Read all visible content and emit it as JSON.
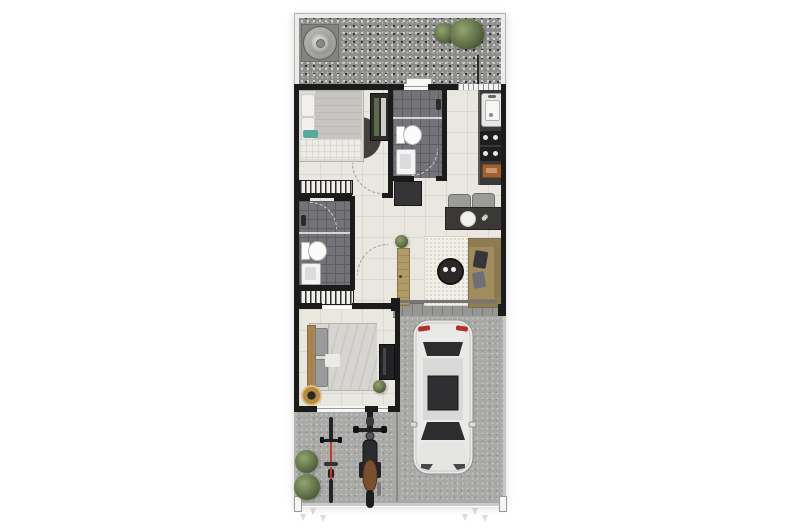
{
  "scene": {
    "type": "floor-plan",
    "style": "3d-rendered top-down plan of a narrow single-storey house with rear gravel yard, two bedrooms, two bathrooms, kitchen strip, living-dining area, front garage and driveway",
    "background": "#ffffff"
  },
  "palette": {
    "wall": "#1b1b1b",
    "patio_frame": "#ebebe9",
    "gravel": "#8d8d8b",
    "floor": "#eae7e1",
    "bath_floor": "#747478",
    "counter": "#39393b",
    "refrigerator": "#353537",
    "step_tile": "#969694",
    "concrete": "#a9a9a7",
    "rug": "#f2efe8",
    "sofa": "#a08c5c",
    "entrance_door": "#b29b67",
    "car_body": "#e9e9e7",
    "car_glass": "#2d2d2f",
    "taillight": "#b23224",
    "bed1_duvet": "#c6c5c2",
    "bed2_duvet": "#d6d5d1",
    "headboard": "#a8854f",
    "teal_throw": "#5ba8a0",
    "plant_green": "#5e7045",
    "moto_seat": "#7a4f2e",
    "cutting_board": "#a35f2c",
    "pouf": "#b78a3e",
    "bicycle_accent": "#c03a28"
  },
  "objects": {
    "outdoor_rear": [
      "water-tank",
      "gravel-yard",
      "shrubs"
    ],
    "rooms": [
      "bedroom-1",
      "bathroom-1",
      "kitchen",
      "hall",
      "bathroom-2",
      "dining-area",
      "living-area",
      "bedroom-2",
      "garage",
      "driveway"
    ],
    "furniture_fixtures": [
      "double-bed",
      "round-rug",
      "wardrobe",
      "linen-closet",
      "toilet",
      "shower-head",
      "washbasin",
      "kitchen-sink",
      "cooktop",
      "cutting-board",
      "refrigerator",
      "dining-table-for-two",
      "sofa",
      "round-coffee-table",
      "area-rug",
      "entrance-door",
      "tv-panel",
      "pouf",
      "potted-plants"
    ],
    "vehicles": [
      "car",
      "motorcycle",
      "bicycle"
    ],
    "site": [
      "landscape-lights",
      "front-shrubs"
    ]
  }
}
